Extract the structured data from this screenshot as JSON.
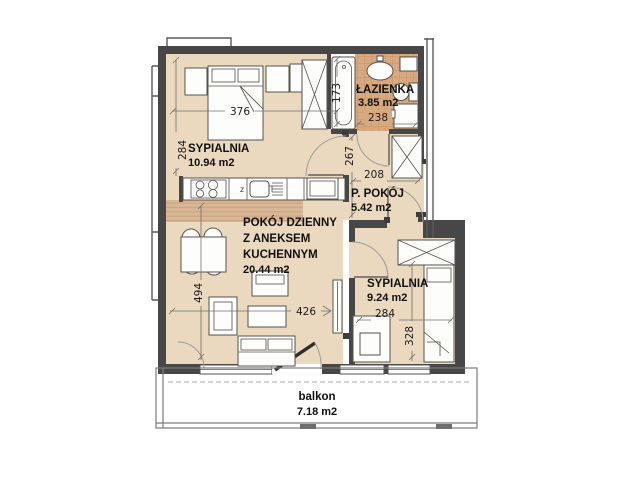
{
  "rooms": {
    "bedroom1": {
      "name": "SYPIALNIA",
      "area": "10.94 m2"
    },
    "bathroom": {
      "name": "ŁAZIENKA",
      "area": "3.85 m2"
    },
    "hallway": {
      "name": "P. POKÓJ",
      "area": "5.42 m2"
    },
    "living": {
      "line1": "POKÓJ DZIENNY",
      "line2": "Z ANEKSEM",
      "line3": "KUCHENNYM",
      "area": "20.44 m2"
    },
    "bedroom2": {
      "name": "SYPIALNIA",
      "area": "9.24 m2"
    },
    "balcony": {
      "name": "balkon",
      "area": "7.18 m2"
    }
  },
  "dimensions": {
    "bedroom1_width": "376",
    "bedroom1_depth": "284",
    "bathtub_length": "173",
    "bathroom_width": "238",
    "hallway_depth": "267",
    "hallway_width": "208",
    "living_depth": "494",
    "living_width": "426",
    "bedroom2_width": "284",
    "bedroom2_depth": "328"
  },
  "kitchen": {
    "sink_mark": "z"
  },
  "colors": {
    "floor": "#EBD9BF",
    "bath_tile": "#D8A87E",
    "bath_tile_line": "#BE8F64",
    "wood_floor": "#D9B795",
    "wood_floor_line": "#C8A279",
    "wall": "#474747",
    "dimension_text": "#1C1C1C"
  }
}
